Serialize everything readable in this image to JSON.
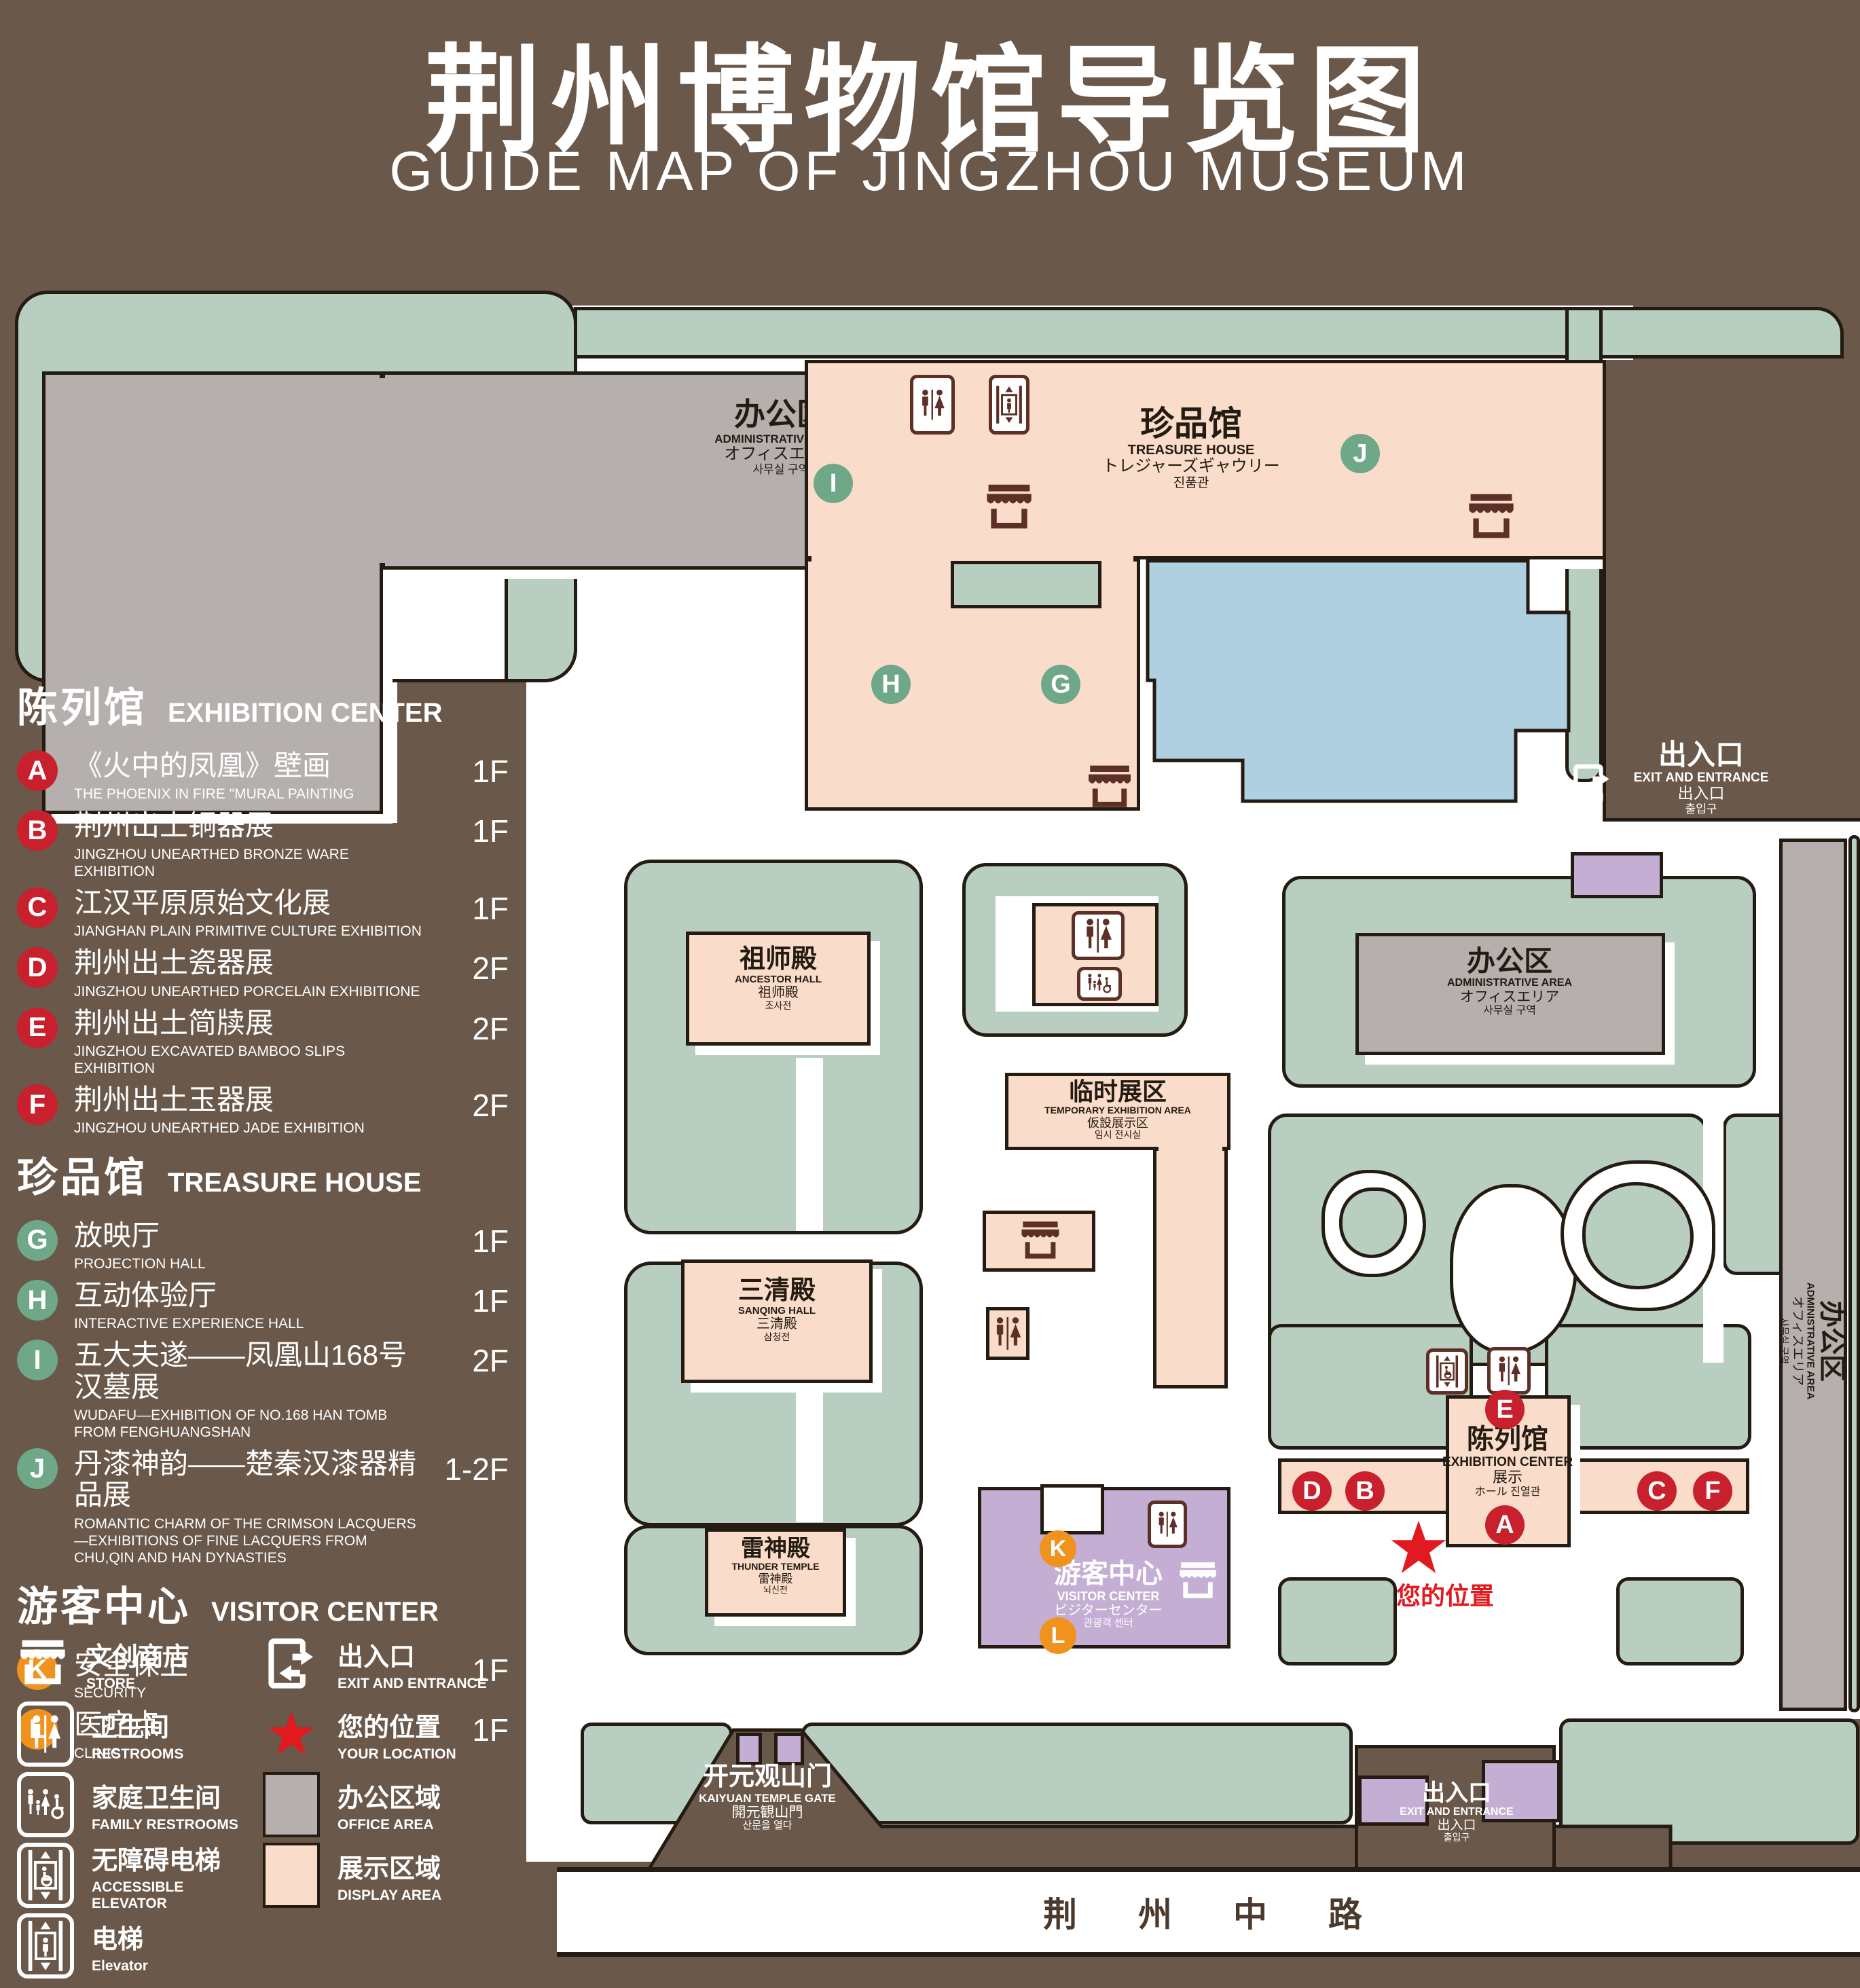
{
  "title": {
    "zh": "荆州博物馆导览图",
    "en": "GUIDE MAP OF JINGZHOU MUSEUM"
  },
  "colors": {
    "background_brown": "#6a584a",
    "park_green": "#b7cec0",
    "display_area_pink": "#f9dcc9",
    "office_area_gray": "#b5b0ae",
    "visitor_center_purple": "#c5aed3",
    "lake_blue": "#afd0e1",
    "marker_red": "#c8202c",
    "marker_green": "#6fa889",
    "marker_orange": "#f0921e",
    "location_red": "#e2191f"
  },
  "legend": {
    "sections": [
      {
        "zh": "陈列馆",
        "en": "EXHIBITION CENTER",
        "items": [
          {
            "id": "A",
            "zh": "《火中的凤凰》壁画",
            "en": "THE PHOENIX IN FIRE \"MURAL PAINTING",
            "floor": "1F"
          },
          {
            "id": "B",
            "zh": "荆州出土铜器展",
            "en": "JINGZHOU UNEARTHED BRONZE WARE EXHIBITION",
            "floor": "1F"
          },
          {
            "id": "C",
            "zh": "江汉平原原始文化展",
            "en": "JIANGHAN PLAIN PRIMITIVE CULTURE EXHIBITION",
            "floor": "1F"
          },
          {
            "id": "D",
            "zh": "荆州出土瓷器展",
            "en": "JINGZHOU UNEARTHED PORCELAIN EXHIBITIONE",
            "floor": "2F"
          },
          {
            "id": "E",
            "zh": "荆州出土简牍展",
            "en": "JINGZHOU EXCAVATED BAMBOO SLIPS EXHIBITION",
            "floor": "2F"
          },
          {
            "id": "F",
            "zh": "荆州出土玉器展",
            "en": "JINGZHOU UNEARTHED JADE EXHIBITION",
            "floor": "2F"
          }
        ]
      },
      {
        "zh": "珍品馆",
        "en": "TREASURE HOUSE",
        "items": [
          {
            "id": "G",
            "zh": "放映厅",
            "en": "PROJECTION HALL",
            "floor": "1F"
          },
          {
            "id": "H",
            "zh": "互动体验厅",
            "en": "INTERACTIVE EXPERIENCE HALL",
            "floor": "1F"
          },
          {
            "id": "I",
            "zh": "五大夫遂——凤凰山168号汉墓展",
            "en": "WUDAFU—EXHIBITION OF NO.168 HAN TOMB FROM FENGHUANGSHAN",
            "floor": "2F"
          },
          {
            "id": "J",
            "zh": "丹漆神韵——楚秦汉漆器精品展",
            "en": "ROMANTIC CHARM OF THE CRIMSON LACQUERS—EXHIBITIONS OF FINE LACQUERS FROM CHU,QIN AND HAN DYNASTIES",
            "floor": "1-2F"
          }
        ]
      },
      {
        "zh": "游客中心",
        "en": "VISITOR CENTER",
        "items": [
          {
            "id": "K",
            "zh": "安全保卫",
            "en": "SECURITY",
            "floor": "1F"
          },
          {
            "id": "L",
            "zh": "医疗点",
            "en": "CLINIC",
            "floor": "1F"
          }
        ]
      }
    ],
    "symbols": [
      {
        "zh": "文创商店",
        "en": "STORE",
        "icon": "store-icon"
      },
      {
        "zh": "出入口",
        "en": "EXIT AND ENTRANCE",
        "icon": "exit-icon"
      },
      {
        "zh": "卫生间",
        "en": "RESTROOMS",
        "icon": "restrooms-icon"
      },
      {
        "zh": "您的位置",
        "en": "YOUR LOCATION",
        "icon": "location-star-icon"
      },
      {
        "zh": "家庭卫生间",
        "en": "FAMILY RESTROOMS",
        "icon": "family-restrooms-icon"
      },
      {
        "zh": "办公区域",
        "en": "OFFICE AREA",
        "swatch": "#b5b0ae"
      },
      {
        "zh": "无障碍电梯",
        "en": "ACCESSIBLE ELEVATOR",
        "icon": "accessible-elevator-icon"
      },
      {
        "zh": "展示区域",
        "en": "DISPLAY AREA",
        "swatch": "#f9dcc9"
      },
      {
        "zh": "电梯",
        "en": "Elevator",
        "icon": "elevator-icon"
      }
    ]
  },
  "map": {
    "admin_area": {
      "zh": "办公区",
      "en": "ADMINISTRATIVE AREA",
      "ja": "オフィスエリア",
      "ko": "사무실 구역"
    },
    "treasure_house": {
      "zh": "珍品馆",
      "en": "TREASURE HOUSE",
      "ja": "トレジャーズギャウリー",
      "ko": "진품관"
    },
    "ancestor_hall": {
      "zh": "祖师殿",
      "en": "ANCESTOR HALL",
      "ja": "祖师殿",
      "ko": "조사전"
    },
    "sanqing_hall": {
      "zh": "三清殿",
      "en": "SANQING HALL",
      "ja": "三清殿",
      "ko": "삼청전"
    },
    "thunder_temple": {
      "zh": "雷神殿",
      "en": "THUNDER TEMPLE",
      "ja": "雷神殿",
      "ko": "뇌신전"
    },
    "temporary_exhibition": {
      "zh": "临时展区",
      "en": "TEMPORARY EXHIBITION AREA",
      "ja": "仮設展示区",
      "ko": "임시 전시실"
    },
    "exhibition_center": {
      "zh": "陈列馆",
      "en": "EXHIBITION CENTER",
      "ja": "展示",
      "ko": "ホール 진열관"
    },
    "visitor_center": {
      "zh": "游客中心",
      "en": "VISITOR CENTER",
      "ja": "ビジターセンター",
      "ko": "관광객 센터"
    },
    "exit_entrance": {
      "zh": "出入口",
      "en": "EXIT AND ENTRANCE",
      "ja": "出入口",
      "ko": "출입구"
    },
    "kaiyuan_gate": {
      "zh": "开元观山门",
      "en": "KAIYUAN TEMPLE GATE",
      "ja": "開元観山門",
      "ko": "산문을 열다"
    },
    "road": "荆 州 中 路",
    "your_location": "您的位置"
  }
}
